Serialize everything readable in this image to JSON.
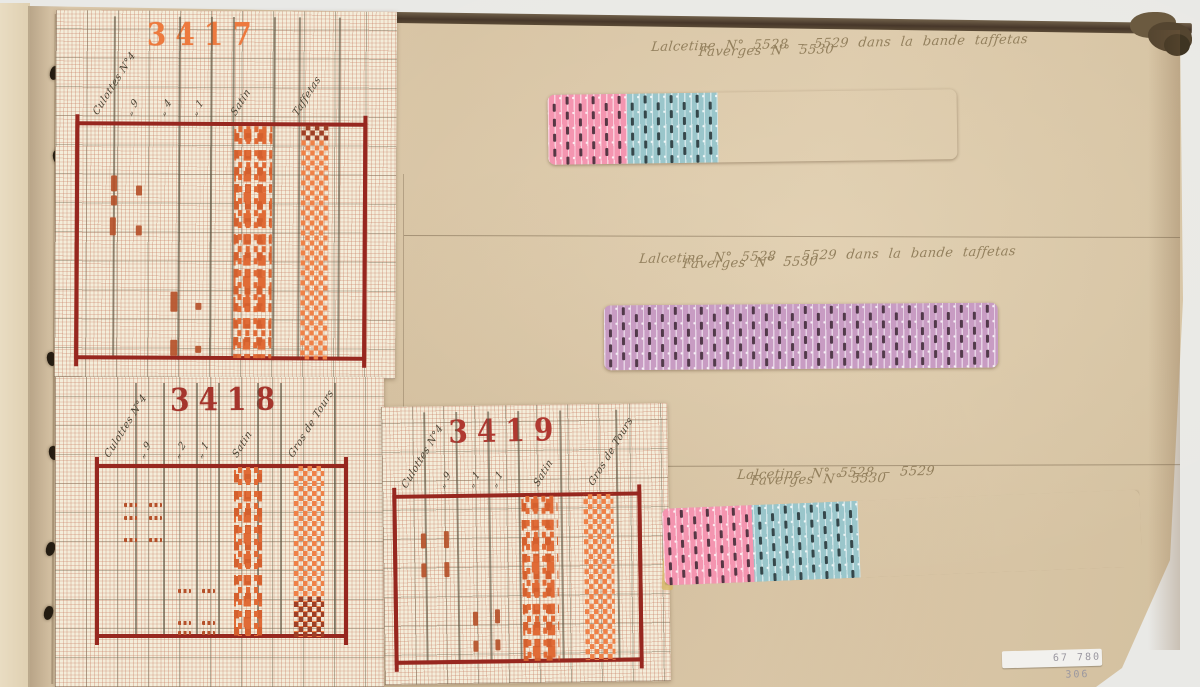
{
  "meta": {
    "description": "Photographed page of a 19th-century textile pattern album: three point-paper weaving drafts (3417, 3418, 3419) pasted at left, three woven striped fabric swatches with handwritten references at right.",
    "inventory_label": "67 780 306"
  },
  "annotations": [
    {
      "line1": "Lalcetine N° 5528 – 5529    dans la bande taffetas",
      "line2": "Faverges N° 5530"
    },
    {
      "line1": "Lalcetine N° 5528 – 5529   dans la bande taffetas",
      "line2": "Faverges N° 5530"
    },
    {
      "line1": "Lalcetine N° 5528 – 5529",
      "line2": "Faverges N° 5530"
    }
  ],
  "colors": {
    "background": "#e9e9e6",
    "page": "#d9c6a8",
    "spine": "#47372a",
    "sheet": "#f4edda",
    "frame_red": "#97271f",
    "mark_orange": "#b5512a",
    "satin_dot": "#e06b36",
    "check_orange": "#ef8147",
    "check_dark": "#9e3f26",
    "ink": "#8d7a57",
    "swatch_beige": "#d9bf82",
    "swatch_blue": "#9ac6cb",
    "swatch_pink": "#f495b0",
    "swatch_mauve": "#c89cc3"
  },
  "charts": [
    {
      "number": "3417",
      "number_color": "#ed7a3e",
      "number_pos": [
        146,
        18
      ],
      "sheet": {
        "x": 55,
        "y": 11,
        "w": 341,
        "h": 367,
        "rot": 0.3
      },
      "labels_baseline": 119,
      "labels": [
        [
          100,
          "Culottes N°4"
        ],
        [
          133,
          "„ 9"
        ],
        [
          166,
          "„ 4"
        ],
        [
          198,
          "„ 1"
        ],
        [
          238,
          "Satin"
        ],
        [
          300,
          "Taffetas"
        ]
      ],
      "frame": {
        "x": 75,
        "y": 122,
        "w": 292,
        "h": 238
      },
      "dividers": [
        113,
        178,
        210,
        232,
        273,
        298,
        338
      ],
      "satin_band": {
        "x": 234,
        "y": 126,
        "w": 38,
        "h": 232
      },
      "check_band": {
        "x": 301,
        "y": 125,
        "w": 27,
        "h": 234
      },
      "check_dark": {
        "x": 301,
        "y": 125,
        "w": 27,
        "h": 15
      },
      "marks": [
        [
          111,
          176,
          6,
          16
        ],
        [
          111,
          196,
          6,
          10
        ],
        [
          136,
          186,
          6,
          10
        ],
        [
          110,
          218,
          6,
          18
        ],
        [
          136,
          226,
          6,
          10
        ],
        [
          171,
          292,
          7,
          20
        ],
        [
          196,
          303,
          6,
          7
        ],
        [
          171,
          340,
          7,
          16
        ],
        [
          196,
          346,
          6,
          7
        ]
      ]
    },
    {
      "number": "3418",
      "number_color": "#a5352c",
      "number_pos": [
        170,
        383
      ],
      "sheet": {
        "x": 55,
        "y": 377,
        "w": 329,
        "h": 310,
        "rot": 0
      },
      "labels_baseline": 461,
      "labels": [
        [
          112,
          "Culottes N°4"
        ],
        [
          146,
          "„ 9"
        ],
        [
          181,
          "„ 2"
        ],
        [
          204,
          "„ 1"
        ],
        [
          240,
          "Satin"
        ],
        [
          296,
          "Gros de Tours"
        ]
      ],
      "frame": {
        "x": 95,
        "y": 464,
        "w": 253,
        "h": 174
      },
      "dividers": [
        135,
        163,
        196,
        218,
        257,
        280,
        334
      ],
      "satin_band": {
        "x": 234,
        "y": 467,
        "w": 28,
        "h": 169
      },
      "check_band": {
        "x": 294,
        "y": 466,
        "w": 30,
        "h": 171
      },
      "check_dark": {
        "x": 294,
        "y": 597,
        "w": 30,
        "h": 40
      },
      "marks": [
        [
          124,
          503,
          13,
          4
        ],
        [
          149,
          503,
          13,
          4
        ],
        [
          124,
          516,
          13,
          4
        ],
        [
          149,
          516,
          13,
          4
        ],
        [
          124,
          538,
          13,
          4
        ],
        [
          149,
          538,
          13,
          4
        ],
        [
          178,
          589,
          13,
          4
        ],
        [
          202,
          589,
          13,
          4
        ],
        [
          178,
          621,
          13,
          4
        ],
        [
          202,
          621,
          13,
          4
        ],
        [
          178,
          631,
          13,
          4
        ],
        [
          202,
          631,
          13,
          4
        ]
      ]
    },
    {
      "number": "3419",
      "number_color": "#b03830",
      "number_pos": [
        450,
        414
      ],
      "sheet": {
        "x": 383,
        "y": 405,
        "w": 286,
        "h": 278,
        "rot": -0.8
      },
      "labels_baseline": 490,
      "labels": [
        [
          410,
          "Culottes N°4"
        ],
        [
          447,
          "„ 9"
        ],
        [
          476,
          "„ 1"
        ],
        [
          499,
          "„ 1"
        ],
        [
          542,
          "Satin"
        ],
        [
          597,
          "Gros de Tours"
        ]
      ],
      "frame": {
        "x": 393,
        "y": 493,
        "w": 249,
        "h": 170
      },
      "dividers": [
        425,
        457,
        489,
        519,
        561,
        617
      ],
      "satin_band": {
        "x": 522,
        "y": 496,
        "w": 36,
        "h": 165
      },
      "check_band": {
        "x": 584,
        "y": 495,
        "w": 30,
        "h": 166
      },
      "marks": [
        [
          421,
          532,
          5,
          15
        ],
        [
          444,
          530,
          5,
          17
        ],
        [
          421,
          562,
          5,
          14
        ],
        [
          444,
          561,
          5,
          15
        ],
        [
          472,
          611,
          5,
          14
        ],
        [
          494,
          609,
          5,
          14
        ],
        [
          472,
          640,
          5,
          11
        ],
        [
          494,
          639,
          5,
          11
        ]
      ]
    }
  ],
  "swatches": [
    {
      "x": 548,
      "y": 92,
      "w": 409,
      "h": 70,
      "rot": -0.8,
      "sections": [
        {
          "name": "beige",
          "color": "#d9bf82",
          "dash": "#34291 7",
          "w": 160
        },
        {
          "name": "blue",
          "color": "#9ac6cb",
          "dash": "#202e31",
          "w": 170
        },
        {
          "name": "pink",
          "color": "#f495b0",
          "dash": "#38222e",
          "w": 79
        }
      ]
    },
    {
      "x": 604,
      "y": 304,
      "w": 394,
      "h": 65,
      "rot": -0.4,
      "sections": [
        {
          "name": "mauve",
          "color": "#c89cc3",
          "dash": "#3a2433",
          "w": 394
        }
      ]
    },
    {
      "x": 663,
      "y": 499,
      "w": 478,
      "h": 77,
      "rot": -2.3,
      "cut_corner": true,
      "sections": [
        {
          "name": "beige",
          "color": "#d9bf82",
          "dash": "#34291 7",
          "w": 192
        },
        {
          "name": "blue",
          "color": "#9ac6cb",
          "dash": "#202e31",
          "w": 196
        },
        {
          "name": "pink",
          "color": "#f495b0",
          "dash": "#38222e",
          "w": 90
        }
      ]
    }
  ],
  "stitches": [
    [
      50,
      66
    ],
    [
      53,
      150
    ],
    [
      47,
      352
    ],
    [
      49,
      446
    ],
    [
      46,
      542
    ],
    [
      44,
      606
    ]
  ]
}
